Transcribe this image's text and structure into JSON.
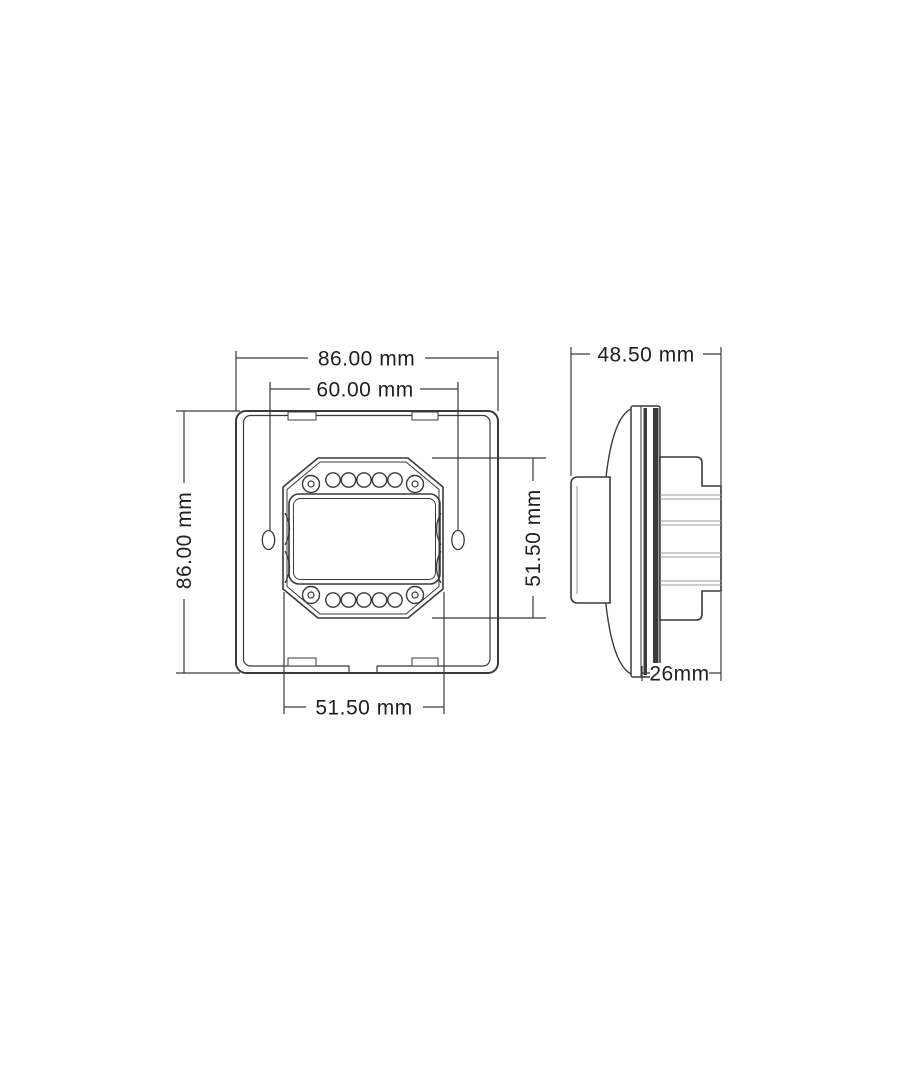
{
  "drawing": {
    "type": "technical-dimension-drawing",
    "subject": "rotary-dimmer-wall-switch",
    "front_view": {
      "dim_width_outer": "86.00 mm",
      "dim_width_mount_holes": "60.00 mm",
      "dim_height_outer": "86.00 mm",
      "dim_height_bracket": "51.50 mm",
      "dim_width_bracket": "51.50 mm",
      "terminal_holes_per_row": 5,
      "terminal_rows": 2,
      "corner_screws": 4,
      "side_mount_slots": 2
    },
    "side_view": {
      "dim_depth_total": "48.50 mm",
      "dim_depth_rear_module": "26mm"
    },
    "colors": {
      "bg": "#ffffff",
      "line": "#3a3a3a",
      "line_light": "#9b9b9b",
      "text": "#1f1f1f"
    }
  }
}
